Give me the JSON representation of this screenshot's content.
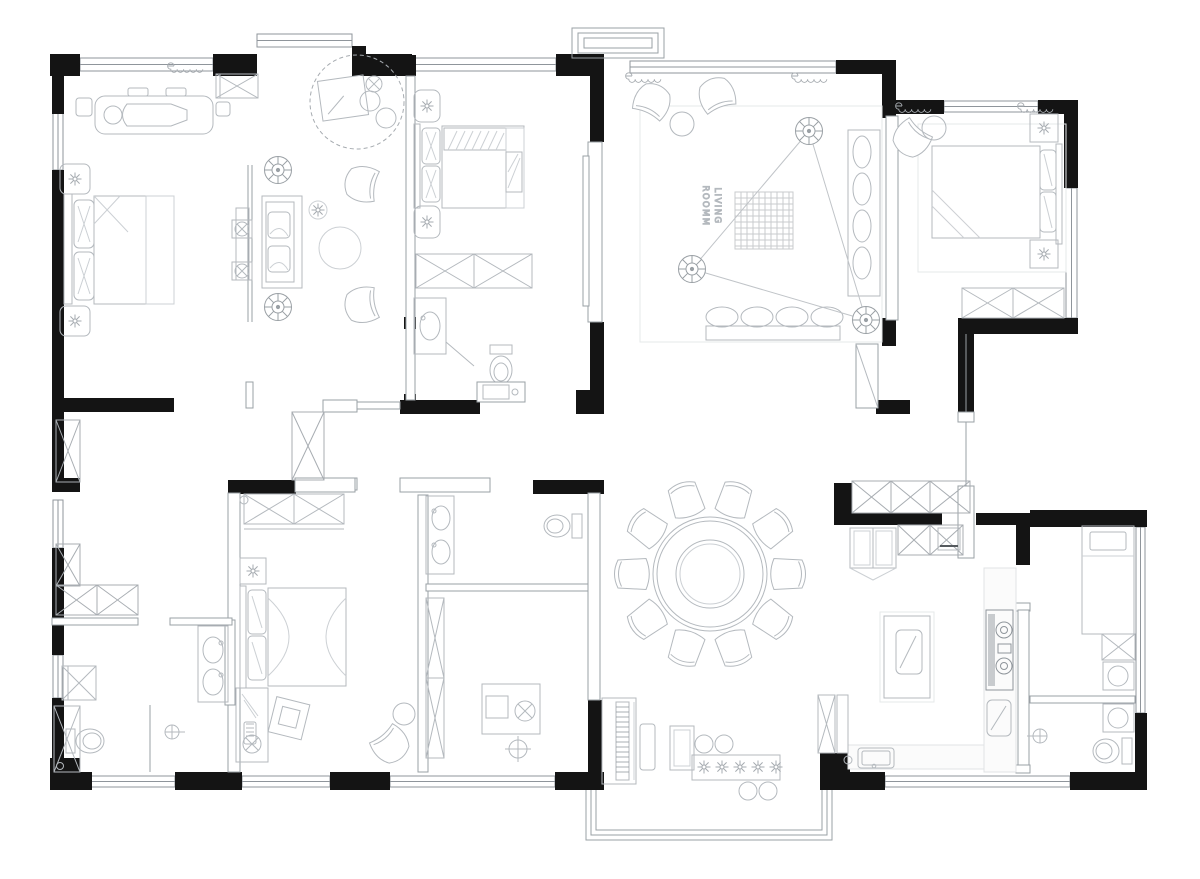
{
  "document": {
    "kind": "residential floor plan drawing",
    "style": "black and white architectural CAD plan",
    "background": "#ffffff"
  },
  "palette": {
    "wall_fill": "#141414",
    "wall_line": "#8f959b",
    "furniture_line": "#b4b9be",
    "furniture_line_soft": "#ccd0d4",
    "floor_line": "#e6e8ea",
    "label_text": "#85898e"
  },
  "labels": {
    "living_room": {
      "display_text": "ROOMM LIVING",
      "line1": "LIVING",
      "line2": "ROOMM",
      "rotation_deg": 90
    }
  },
  "rooms": [
    {
      "id": "master-bedroom",
      "furniture": [
        "double bed",
        "two nightstands with lamps",
        "chaise lounge",
        "entry cabinet",
        "closet bay with window"
      ]
    },
    {
      "id": "master-sitting-area",
      "furniture": [
        "tv console with two speakers",
        "bench sofa with cushions",
        "two armchairs",
        "round ottoman",
        "flower stand",
        "desk nook in dashed circle",
        "two ceiling lights"
      ]
    },
    {
      "id": "dressing-corridor",
      "furniture": [
        "wardrobes",
        "low cabinet"
      ]
    },
    {
      "id": "master-bathroom",
      "furniture": [
        "double vanity",
        "toilet",
        "shower stall",
        "washer cabinet",
        "shower head"
      ]
    },
    {
      "id": "bedroom-2",
      "furniture": [
        "double bed with hatched duvet",
        "two nightstands with lamps",
        "wardrobe"
      ]
    },
    {
      "id": "bathroom-2",
      "furniture": [
        "vanity sink",
        "toilet",
        "corner shower",
        "small vanity"
      ]
    },
    {
      "id": "living-room",
      "furniture": [
        "two armchairs",
        "round side table",
        "gridded area rug",
        "corner sofa",
        "cushion bench",
        "three ceiling lights connected by wiring triangle"
      ]
    },
    {
      "id": "bedroom-3",
      "furniture": [
        "double bed",
        "two square nightstands with lamps",
        "armchair",
        "round side table",
        "wardrobe",
        "rug"
      ]
    },
    {
      "id": "bedroom-4",
      "furniture": [
        "double bed",
        "wardrobe",
        "desk",
        "tilted laptop table",
        "armchair",
        "round side table",
        "bedside lamp cabinet"
      ]
    },
    {
      "id": "bathroom-3",
      "furniture": [
        "double vanity",
        "toilet"
      ]
    },
    {
      "id": "study",
      "furniture": [
        "desk with monitor",
        "chair",
        "tall wardrobe",
        "ceiling light"
      ]
    },
    {
      "id": "dining-room",
      "furniture": [
        "round dining table with lazy susan",
        "ten chairs"
      ]
    },
    {
      "id": "kitchen",
      "furniture": [
        "fridge",
        "upper cabinets",
        "island with sink",
        "two-burner cooktop",
        "second sink",
        "prep counter sink"
      ]
    },
    {
      "id": "utility-room",
      "furniture": [
        "single bed",
        "cabinet",
        "two washing machines",
        "toilet",
        "shower head"
      ]
    },
    {
      "id": "music-corner",
      "furniture": [
        "upright piano with keys",
        "piano bench",
        "side table",
        "planter box with five flowers",
        "four plant pots"
      ]
    },
    {
      "id": "bay-window",
      "furniture": [
        "triple-line window band"
      ]
    }
  ],
  "symbols": [
    "ceiling-light-icon",
    "lamp-star-icon",
    "flower-icon",
    "curtain-coil-icon",
    "wardrobe-x-icon",
    "shower-icon",
    "sink-icon",
    "toilet-icon",
    "washer-icon"
  ]
}
